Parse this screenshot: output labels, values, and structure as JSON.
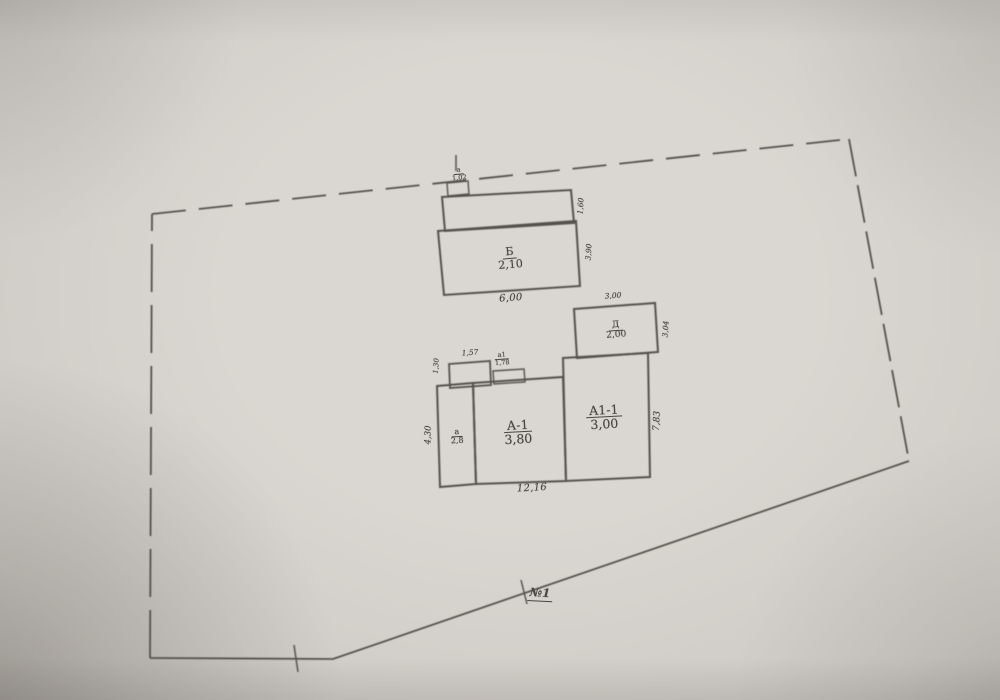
{
  "drawing": {
    "parcel_point_label": "№1",
    "buildings": {
      "b": {
        "letter": "Б",
        "value": "2,10"
      },
      "porch_top": {
        "letter": "а",
        "value": "1,02"
      },
      "shed": {
        "letter": "Д",
        "value": "2,00"
      },
      "room_left": {
        "letter": "а",
        "value": "2,8"
      },
      "room_main": {
        "letter": "А-1",
        "value": "3,80"
      },
      "room_right": {
        "letter": "А1-1",
        "value": "3,00"
      },
      "porch_a1": {
        "letter": "а1",
        "value": "1,78"
      }
    },
    "dimensions": {
      "b_width": "6,00",
      "b_strip_depth": "1,60",
      "b_depth": "3,90",
      "shed_width": "3,00",
      "shed_depth": "3,04",
      "proj_width": "1,57",
      "proj_depth": "1,30",
      "room_left_depth": "4,30",
      "main_width": "12,16",
      "main_depth": "7,83"
    },
    "ink_color": "#56514c",
    "paper_color": "#d5d1cc"
  }
}
